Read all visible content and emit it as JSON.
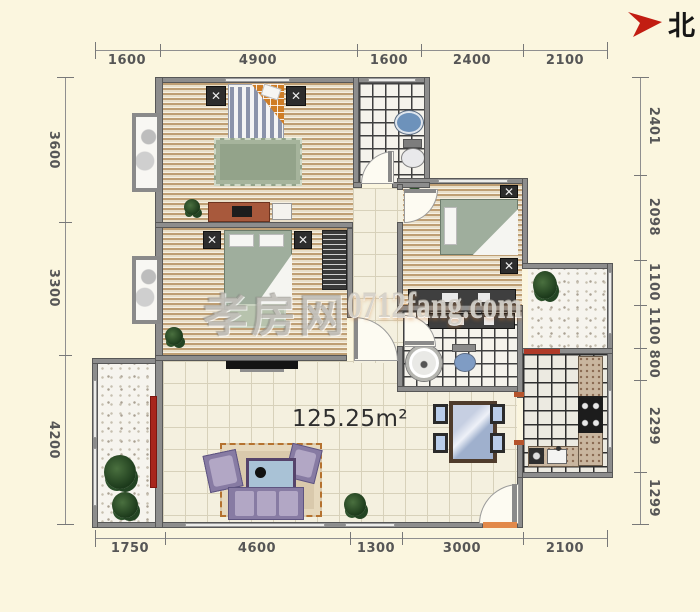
{
  "north": {
    "label": "北"
  },
  "area_label": "125.25m²",
  "watermark": {
    "brand": "孝房网",
    "site": "0712fang.com"
  },
  "dims": {
    "top": [
      "1600",
      "4900",
      "1600",
      "2400",
      "2100"
    ],
    "bottom": [
      "1750",
      "4600",
      "1300",
      "3000",
      "2100"
    ],
    "left": [
      "3600",
      "3300",
      "4200"
    ],
    "right": [
      "2401",
      "2098",
      "1100",
      "1100",
      "800",
      "2299",
      "1299"
    ]
  },
  "colors": {
    "background": "#fbf6df",
    "north_arrow": "#c21d12",
    "entry_sill": "#e2894a",
    "balcony_door": "#a8251c",
    "dimension_text": "#565656"
  }
}
